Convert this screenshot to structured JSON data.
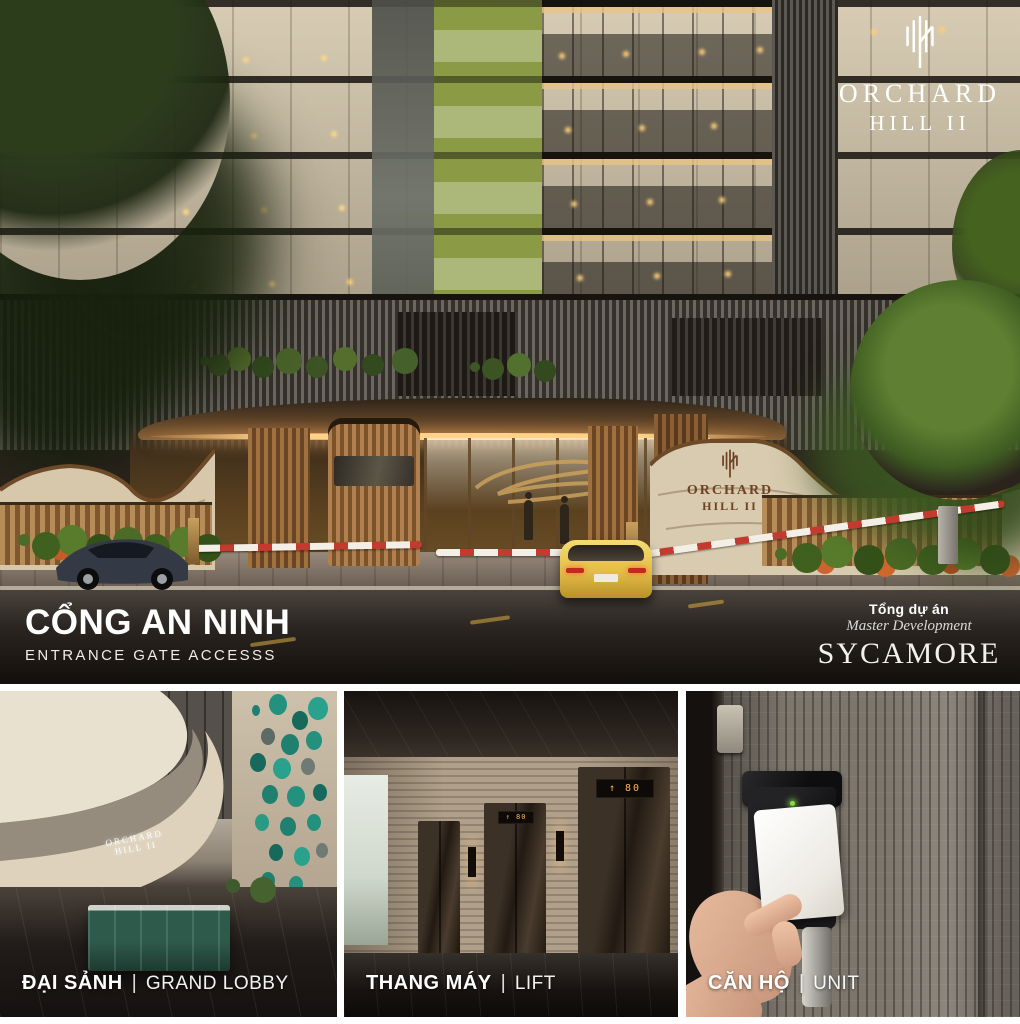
{
  "brand": {
    "name_line1": "ORCHARD",
    "name_line2": "HILL II"
  },
  "hero": {
    "heading_vi": "CỔNG AN NINH",
    "heading_en": "ENTRANCE GATE ACCESSS",
    "developer_label_vi": "Tổng dự án",
    "developer_label_en": "Master Development",
    "developer_name": "SYCAMORE"
  },
  "lobby_wall_sign_line1": "ORCHARD",
  "lobby_wall_sign_line2": "HILL II",
  "lift_display": "↑ 80",
  "panels": [
    {
      "label_vi": "ĐẠI SẢNH",
      "divider": "|",
      "label_en": "GRAND LOBBY"
    },
    {
      "label_vi": "THANG MÁY",
      "divider": "|",
      "label_en": "LIFT"
    },
    {
      "label_vi": "CĂN HỘ",
      "divider": "|",
      "label_en": "UNIT"
    }
  ],
  "colors": {
    "accent_olive": "#8a9a45",
    "canopy_gold": "#ffd189",
    "teal_glass": "#1f8070",
    "barrier_red": "#c23b2e",
    "led_green": "#8be04a"
  }
}
